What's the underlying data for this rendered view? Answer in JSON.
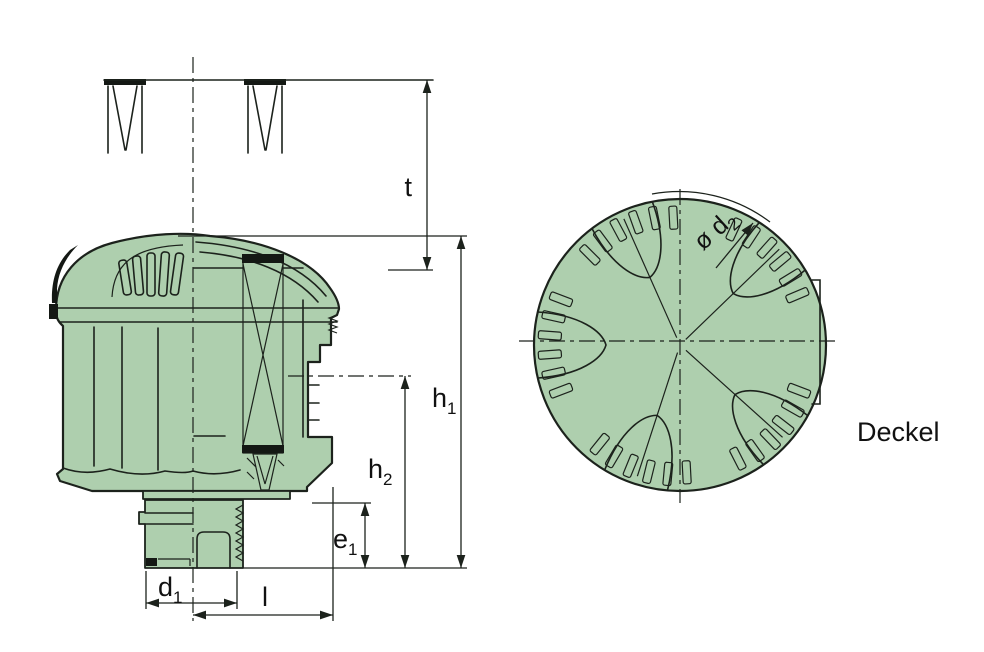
{
  "drawing": {
    "caption": "Deckel",
    "dimensions": {
      "t": {
        "base": "t",
        "sub": ""
      },
      "h1": {
        "base": "h",
        "sub": "1"
      },
      "h2": {
        "base": "h",
        "sub": "2"
      },
      "e1": {
        "base": "e",
        "sub": "1"
      },
      "d1": {
        "base": "d",
        "sub": "1"
      },
      "l": {
        "base": "l",
        "sub": ""
      },
      "d2": {
        "base": "ø d",
        "sub": "2"
      }
    }
  },
  "colors": {
    "part_fill": "#aecfae",
    "line": "#1c221c",
    "dark": "#141814",
    "background": "#ffffff"
  }
}
